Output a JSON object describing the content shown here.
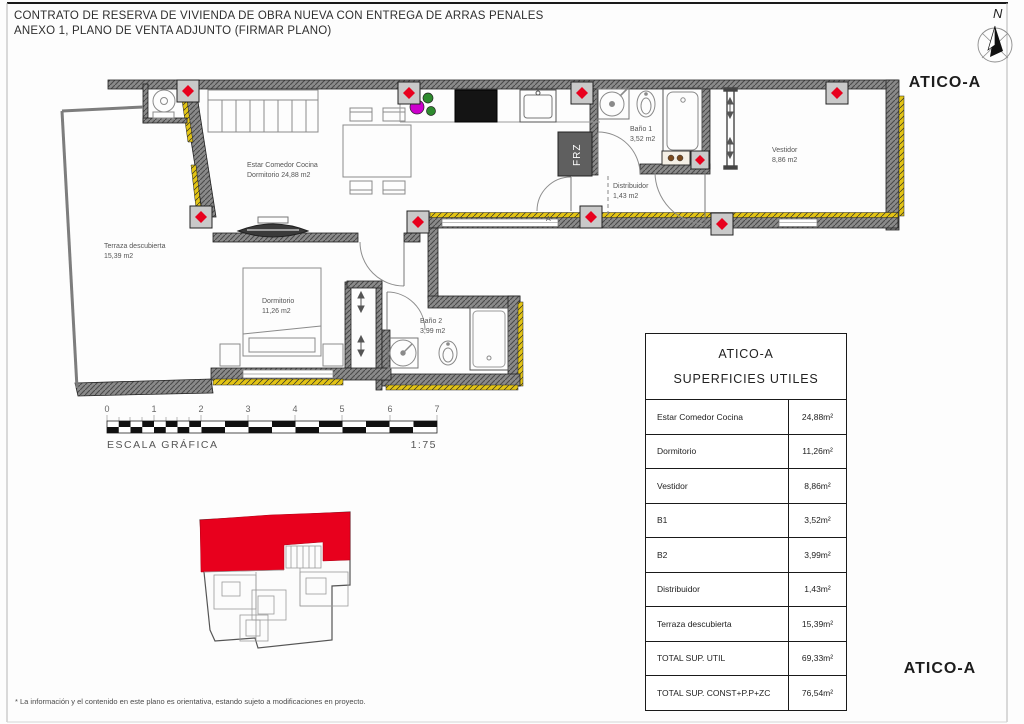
{
  "header": {
    "title_line1": "CONTRATO DE RESERVA DE VIVIENDA DE OBRA NUEVA CON ENTREGA DE ARRAS PENALES",
    "title_line2": "ANEXO 1, PLANO DE VENTA ADJUNTO (FIRMAR PLANO)"
  },
  "compass": {
    "north_label": "N"
  },
  "unit": {
    "name": "ATICO-A"
  },
  "plan": {
    "labels": {
      "terraza": {
        "name": "Terraza descubierta",
        "area": "15,39 m2"
      },
      "estar": {
        "name": "Estar Comedor Cocina",
        "area": "Dormitorio 24,88 m2"
      },
      "dormitorio": {
        "name": "Dormitorio",
        "area": "11,26 m2"
      },
      "bano1": {
        "name": "Baño 1",
        "area": "3,52 m2"
      },
      "bano2": {
        "name": "Baño 2",
        "area": "3,99 m2"
      },
      "distribuidor": {
        "name": "Distribuidor",
        "area": "1,43 m2"
      },
      "vestidor": {
        "name": "Vestidor",
        "area": "8,86 m2"
      },
      "freezer": "FRZ",
      "section_mark": "A"
    }
  },
  "scale_bar": {
    "ticks": [
      "0",
      "1",
      "2",
      "3",
      "4",
      "5",
      "6",
      "7"
    ],
    "caption": "ESCALA GRÁFICA",
    "ratio": "1:75"
  },
  "table": {
    "title": "ATICO-A",
    "subtitle": "SUPERFICIES UTILES",
    "rows": [
      {
        "label": "Estar Comedor Cocina",
        "value": "24,88m²"
      },
      {
        "label": "Dormitorio",
        "value": "11,26m²"
      },
      {
        "label": "Vestidor",
        "value": "8,86m²"
      },
      {
        "label": "B1",
        "value": "3,52m²"
      },
      {
        "label": "B2",
        "value": "3,99m²"
      },
      {
        "label": "Distribuidor",
        "value": "1,43m²"
      },
      {
        "label": "Terraza descubierta",
        "value": "15,39m²"
      },
      {
        "label": "TOTAL SUP. UTIL",
        "value": "69,33m²"
      },
      {
        "label": "TOTAL SUP. CONST+P.P+ZC",
        "value": "76,54m²"
      }
    ]
  },
  "footer": {
    "disclaimer": "* La información y el contenido en este plano es orientativa, estando sujeto a modificaciones en proyecto."
  },
  "colors": {
    "highlight": "#e8001d",
    "insulation": "#e3c414",
    "wall": "#8a8a8a"
  }
}
